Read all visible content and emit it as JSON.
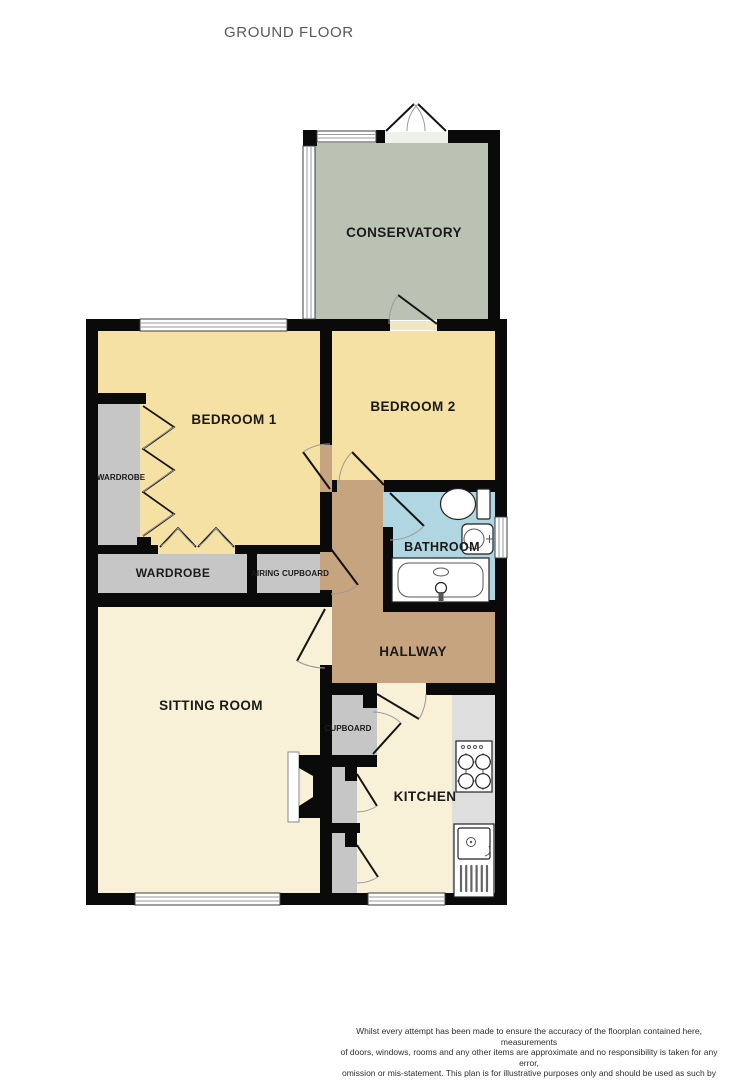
{
  "title": "GROUND FLOOR",
  "theme": {
    "wall": "#0a0a0a",
    "door_arc": "#9b9b9b",
    "label": "#1a1a1a"
  },
  "rooms": {
    "conservatory": {
      "label": "CONSERVATORY",
      "color": "#b9c2b3"
    },
    "bedroom1": {
      "label": "BEDROOM 1",
      "color": "#f5e1a4"
    },
    "bedroom2": {
      "label": "BEDROOM 2",
      "color": "#f5e1a4"
    },
    "bathroom": {
      "label": "BATHROOM",
      "color": "#b0d6e2"
    },
    "hallway": {
      "label": "HALLWAY",
      "color": "#c6a47f"
    },
    "sitting_room": {
      "label": "SITTING ROOM",
      "color": "#f8f1d8"
    },
    "kitchen": {
      "label": "KITCHEN",
      "color": "#f8f1d8"
    },
    "wardrobe_side": {
      "label": "WARDROBE",
      "color": "#c6c6c6"
    },
    "wardrobe": {
      "label": "WARDROBE",
      "color": "#c6c6c6"
    },
    "airing_cupboard": {
      "label": "AIRING CUPBOARD",
      "color": "#c6c6c6"
    },
    "cupboard": {
      "label": "CUPBOARD",
      "color": "#c6c6c6"
    },
    "counter": {
      "color": "#dedede"
    }
  },
  "footer": {
    "line1": "Whilst every attempt has been made to ensure the accuracy of the floorplan contained here, measurements",
    "line2": "of doors, windows, rooms and any other items are approximate and no responsibility is taken for any error,",
    "line3": "omission or mis-statement. This plan is for illustrative purposes only and should be used as such by any",
    "line4": "prospective purchaser. The services, systems and appliances shown have not been tested and no guarantee",
    "line5": "as to their operability or efficiency can be given.",
    "credit": "Made with Metropix ©2026"
  }
}
